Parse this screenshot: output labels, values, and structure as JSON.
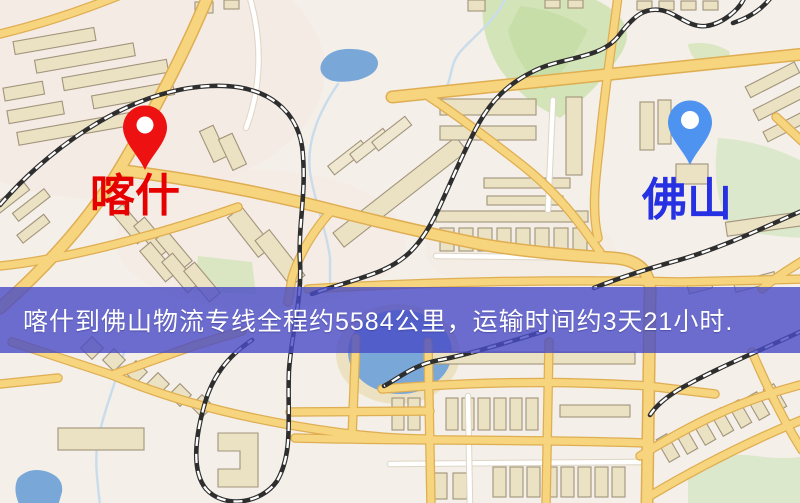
{
  "banner": {
    "text": "喀什到佛山物流专线全程约5584公里，运输时间约3天21小时.",
    "background_color": "#4a4bc5",
    "text_color": "#ffffff"
  },
  "route": {
    "origin": "喀什",
    "destination": "佛山",
    "distance_text": "约5584公里",
    "duration_text": "约3天21小时"
  },
  "markers": [
    {
      "id": "kashi",
      "label": "喀什",
      "label_color": "#e60000",
      "pin_color": "#ee1111"
    },
    {
      "id": "foshan",
      "label": "佛山",
      "label_color": "#2531e2",
      "pin_color": "#4f93f0"
    }
  ],
  "map": {
    "type": "street-map",
    "colors": {
      "background": "#f4efe8",
      "road_fill": "#f6d57e",
      "road_casing": "#dfae52",
      "minor_road": "#ffffff",
      "park": "#d3e5b8",
      "water": "#79a8d8",
      "building": "#ebe1c3",
      "railway": "#2e2e2e"
    }
  }
}
